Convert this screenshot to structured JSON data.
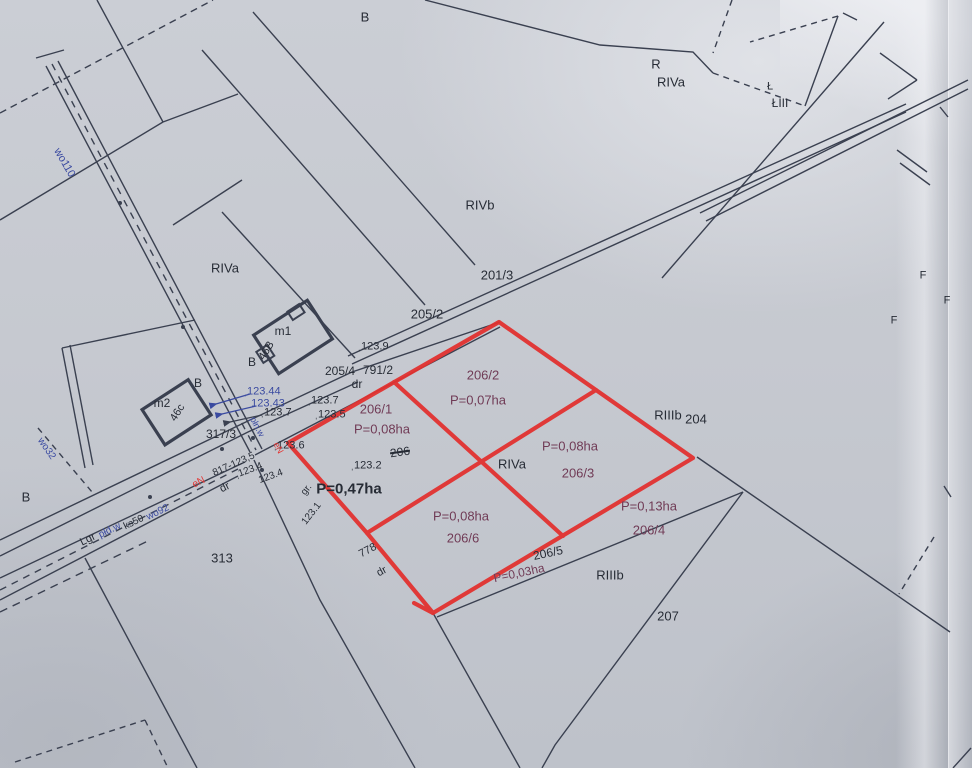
{
  "colors": {
    "paper": "#c6c9d0",
    "ink_line": "#3a4050",
    "ink_text": "#262b35",
    "highlight_red": "#e23230",
    "utility_blue": "#3a4aa0",
    "parcel_purple": "#6f3a55"
  },
  "labels": [
    {
      "n": "region-b-top",
      "t": "B",
      "x": 365,
      "y": 17,
      "c": "ink",
      "s": 13
    },
    {
      "n": "region-r",
      "t": "R",
      "x": 656,
      "y": 64,
      "c": "ink",
      "s": 13
    },
    {
      "n": "region-riva-ne",
      "t": "RIVa",
      "x": 671,
      "y": 82,
      "c": "ink",
      "s": 13
    },
    {
      "n": "region-l",
      "t": "Ł",
      "x": 770,
      "y": 87,
      "c": "ink",
      "s": 11
    },
    {
      "n": "region-liii",
      "t": "ŁIII",
      "x": 780,
      "y": 103,
      "c": "ink",
      "s": 12
    },
    {
      "n": "region-rivb",
      "t": "RIVb",
      "x": 480,
      "y": 205,
      "c": "ink",
      "s": 13
    },
    {
      "n": "parcel-201-3",
      "t": "201/3",
      "x": 497,
      "y": 275,
      "c": "ink",
      "s": 13
    },
    {
      "n": "parcel-205-2",
      "t": "205/2",
      "x": 427,
      "y": 314,
      "c": "ink",
      "s": 13
    },
    {
      "n": "spot-123-9",
      "t": "ˌ123.9",
      "x": 373,
      "y": 347,
      "c": "ink",
      "s": 11
    },
    {
      "n": "parcel-205-4",
      "t": "205/4",
      "x": 340,
      "y": 371,
      "c": "ink",
      "s": 12
    },
    {
      "n": "parcel-791-2",
      "t": "791/2",
      "x": 378,
      "y": 370,
      "c": "ink",
      "s": 12
    },
    {
      "n": "road-dr-791",
      "t": "dr",
      "x": 357,
      "y": 384,
      "c": "ink",
      "s": 12
    },
    {
      "n": "spot-123-7-e",
      "t": "ˌ123.7",
      "x": 323,
      "y": 401,
      "c": "ink",
      "s": 11
    },
    {
      "n": "spot-123-5",
      "t": "ˌ123.5",
      "x": 330,
      "y": 415,
      "c": "ink",
      "s": 11
    },
    {
      "n": "region-riva-nw",
      "t": "RIVa",
      "x": 225,
      "y": 268,
      "c": "ink",
      "s": 13
    },
    {
      "n": "parcel-206-1",
      "t": "206/1",
      "x": 376,
      "y": 409,
      "c": "purple",
      "s": 13
    },
    {
      "n": "area-206-1",
      "t": "P=0,08ha",
      "x": 382,
      "y": 429,
      "c": "purple",
      "s": 13
    },
    {
      "n": "parcel-206-2",
      "t": "206/2",
      "x": 483,
      "y": 375,
      "c": "purple",
      "s": 13
    },
    {
      "n": "area-206-2",
      "t": "P=0,07ha",
      "x": 478,
      "y": 400,
      "c": "purple",
      "s": 13
    },
    {
      "n": "region-riva-mid",
      "t": "RIVa",
      "x": 512,
      "y": 464,
      "c": "ink",
      "s": 13
    },
    {
      "n": "area-206-3",
      "t": "P=0,08ha",
      "x": 570,
      "y": 446,
      "c": "purple",
      "s": 13
    },
    {
      "n": "parcel-206-3",
      "t": "206/3",
      "x": 578,
      "y": 473,
      "c": "purple",
      "s": 13
    },
    {
      "n": "region-riiib-ne",
      "t": "RIIIb",
      "x": 668,
      "y": 415,
      "c": "ink",
      "s": 13
    },
    {
      "n": "parcel-204",
      "t": "204",
      "x": 696,
      "y": 419,
      "c": "ink",
      "s": 13
    },
    {
      "n": "parcel-206-struck",
      "t": "206",
      "x": 400,
      "y": 452,
      "c": "ink",
      "s": 12,
      "r": -8,
      "k": true
    },
    {
      "n": "spot-123-2",
      "t": "ˌ123.2",
      "x": 366,
      "y": 466,
      "c": "ink",
      "s": 11
    },
    {
      "n": "area-total",
      "t": "P=0,47ha",
      "x": 349,
      "y": 489,
      "c": "ink",
      "s": 15,
      "b": true
    },
    {
      "n": "spot-123-6",
      "t": "ˌ123.6",
      "x": 289,
      "y": 446,
      "c": "ink",
      "s": 11
    },
    {
      "n": "spot-123-44",
      "t": "ˌ123.44",
      "x": 262,
      "y": 392,
      "c": "blue",
      "s": 11
    },
    {
      "n": "spot-123-43",
      "t": "123.43",
      "x": 268,
      "y": 404,
      "c": "blue",
      "s": 11
    },
    {
      "n": "spot-123-7-w",
      "t": "ˌ123.7",
      "x": 276,
      "y": 413,
      "c": "ink",
      "s": 11
    },
    {
      "n": "parcel-317-3",
      "t": "317/3",
      "x": 221,
      "y": 434,
      "c": "ink",
      "s": 12
    },
    {
      "n": "building-m1-label",
      "t": "m1",
      "x": 283,
      "y": 331,
      "c": "ink",
      "s": 12
    },
    {
      "n": "building-46b-label",
      "t": "46B",
      "x": 267,
      "y": 351,
      "c": "ink",
      "s": 11,
      "r": -58
    },
    {
      "n": "region-b-m1",
      "t": "B",
      "x": 252,
      "y": 362,
      "c": "ink",
      "s": 12
    },
    {
      "n": "region-b-road",
      "t": "B",
      "x": 198,
      "y": 383,
      "c": "ink",
      "s": 12
    },
    {
      "n": "building-m2-label",
      "t": "m2",
      "x": 162,
      "y": 403,
      "c": "ink",
      "s": 12
    },
    {
      "n": "building-46c-label",
      "t": "46c",
      "x": 178,
      "y": 413,
      "c": "ink",
      "s": 11,
      "r": -58
    },
    {
      "n": "parcel-313",
      "t": "313",
      "x": 222,
      "y": 558,
      "c": "ink",
      "s": 13
    },
    {
      "n": "region-b-sw",
      "t": "B",
      "x": 26,
      "y": 497,
      "c": "ink",
      "s": 13
    },
    {
      "n": "utility-wo110",
      "t": "wo110",
      "x": 64,
      "y": 163,
      "c": "blue",
      "s": 11,
      "r": 60
    },
    {
      "n": "utility-wo32",
      "t": "wo32",
      "x": 46,
      "y": 449,
      "c": "blue",
      "s": 10,
      "r": 55
    },
    {
      "n": "utility-pln-w",
      "t": "płn.w",
      "x": 257,
      "y": 427,
      "c": "blue",
      "s": 9,
      "r": 62
    },
    {
      "n": "utility-en-north",
      "t": "eN",
      "x": 278,
      "y": 448,
      "c": "red",
      "s": 9,
      "r": 62
    },
    {
      "n": "road-lgr",
      "t": "Lgr",
      "x": 88,
      "y": 540,
      "c": "ink",
      "s": 11,
      "r": -26
    },
    {
      "n": "utility-pld-w",
      "t": "płd.w",
      "x": 110,
      "y": 531,
      "c": "blue",
      "s": 10,
      "r": -26
    },
    {
      "n": "utility-ks50",
      "t": "ks50",
      "x": 134,
      "y": 523,
      "c": "ink",
      "s": 10,
      "r": -26
    },
    {
      "n": "utility-wo92",
      "t": "wo92",
      "x": 158,
      "y": 513,
      "c": "blue",
      "s": 10,
      "r": -26
    },
    {
      "n": "utility-en",
      "t": "eN",
      "x": 199,
      "y": 483,
      "c": "red",
      "s": 10,
      "r": -26
    },
    {
      "n": "road-dr-main",
      "t": "dr",
      "x": 225,
      "y": 488,
      "c": "ink",
      "s": 11,
      "r": -26
    },
    {
      "n": "note-817",
      "t": "817-123,5",
      "x": 234,
      "y": 465,
      "c": "ink",
      "s": 10,
      "r": -24
    },
    {
      "n": "spot-123-4-a",
      "t": "ˌ123.4",
      "x": 249,
      "y": 471,
      "c": "ink",
      "s": 10,
      "r": -20
    },
    {
      "n": "spot-123-4-b",
      "t": "123.4",
      "x": 271,
      "y": 477,
      "c": "ink",
      "s": 10,
      "r": -20
    },
    {
      "n": "note-gr",
      "t": "gr.",
      "x": 307,
      "y": 490,
      "c": "ink",
      "s": 10,
      "r": -52
    },
    {
      "n": "spot-123-1",
      "t": "123.1",
      "x": 312,
      "y": 514,
      "c": "ink",
      "s": 10,
      "r": -52
    },
    {
      "n": "parcel-778",
      "t": "778",
      "x": 368,
      "y": 551,
      "c": "ink",
      "s": 11,
      "r": -28
    },
    {
      "n": "road-dr-778",
      "t": "dr",
      "x": 382,
      "y": 572,
      "c": "ink",
      "s": 11,
      "r": -28
    },
    {
      "n": "area-206-6",
      "t": "P=0,08ha",
      "x": 461,
      "y": 516,
      "c": "purple",
      "s": 13
    },
    {
      "n": "parcel-206-6",
      "t": "206/6",
      "x": 463,
      "y": 538,
      "c": "purple",
      "s": 13
    },
    {
      "n": "parcel-206-5",
      "t": "206/5",
      "x": 548,
      "y": 553,
      "c": "ink",
      "s": 12,
      "r": -12
    },
    {
      "n": "area-206-5",
      "t": "P=0,03ha",
      "x": 519,
      "y": 573,
      "c": "purple",
      "s": 12,
      "r": -12
    },
    {
      "n": "area-206-4",
      "t": "P=0,13ha",
      "x": 649,
      "y": 506,
      "c": "purple",
      "s": 13
    },
    {
      "n": "parcel-206-4",
      "t": "206/4",
      "x": 649,
      "y": 530,
      "c": "purple",
      "s": 13
    },
    {
      "n": "region-riiib-s",
      "t": "RIIIb",
      "x": 610,
      "y": 575,
      "c": "ink",
      "s": 13
    },
    {
      "n": "parcel-207",
      "t": "207",
      "x": 668,
      "y": 616,
      "c": "ink",
      "s": 13
    },
    {
      "n": "margin-f-1",
      "t": "F",
      "x": 923,
      "y": 276,
      "c": "ink",
      "s": 11
    },
    {
      "n": "margin-f-2",
      "t": "F",
      "x": 947,
      "y": 301,
      "c": "ink",
      "s": 11
    },
    {
      "n": "margin-f-3",
      "t": "F",
      "x": 894,
      "y": 321,
      "c": "ink",
      "s": 11
    }
  ]
}
